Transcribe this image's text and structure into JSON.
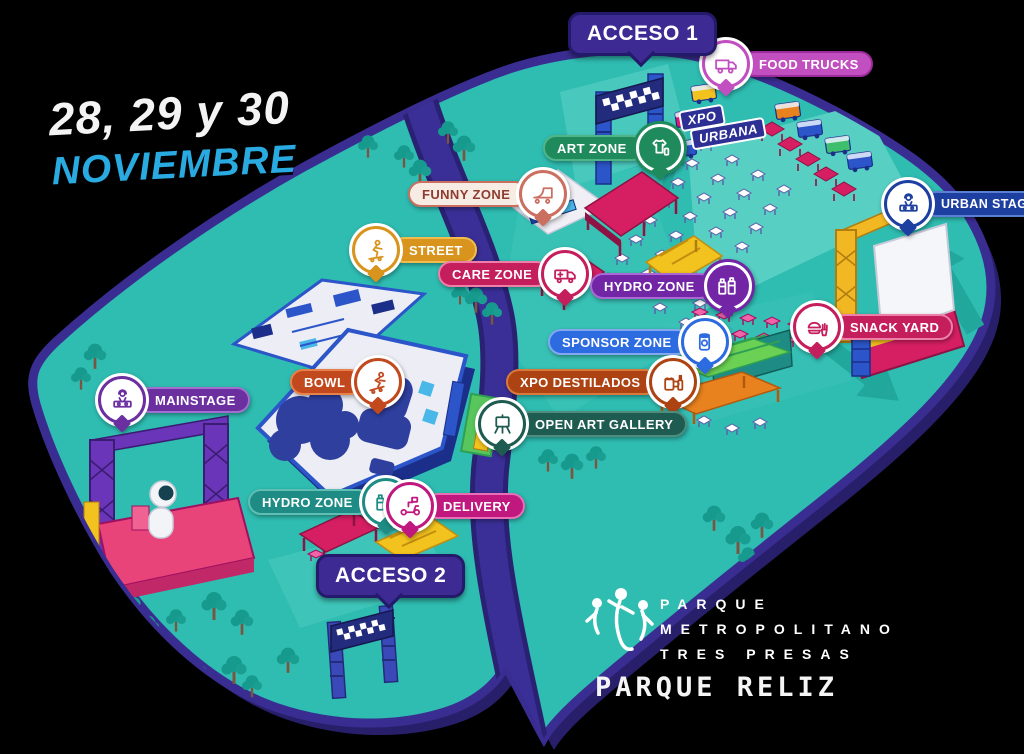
{
  "event": {
    "dates_line1": "28, 29 y 30",
    "dates_line2": "NOVIEMBRE"
  },
  "access": [
    {
      "label": "ACCESO 1"
    },
    {
      "label": "ACCESO 2"
    }
  ],
  "pins": [
    {
      "id": "food-trucks",
      "label": "FOOD TRUCKS",
      "icon": "food-truck-icon",
      "icon_side": "left",
      "color": "#C24FC0",
      "border": "#9E2B9B"
    },
    {
      "id": "art-zone",
      "label": "ART ZONE",
      "icon": "tshirt-icon",
      "icon_side": "right",
      "color": "#1F8A5B",
      "border": "#4FB586"
    },
    {
      "id": "funny-zone",
      "label": "FUNNY ZONE",
      "icon": "mini-ramp-icon",
      "icon_side": "right",
      "color": "#F7ECE4",
      "border": "#CB6F60"
    },
    {
      "id": "street",
      "label": "STREET",
      "icon": "skater-icon",
      "icon_side": "left",
      "color": "#D8941D",
      "border": "#F0BC50"
    },
    {
      "id": "care-zone",
      "label": "CARE ZONE",
      "icon": "ambulance-icon",
      "icon_side": "right",
      "color": "#C41E5C",
      "border": "#ED7FA8"
    },
    {
      "id": "hydro-zone-top",
      "label": "HYDRO ZONE",
      "icon": "water-jugs-icon",
      "icon_side": "right",
      "color": "#7226A6",
      "border": "#A968D4"
    },
    {
      "id": "urban-stage",
      "label": "URBAN STAGE",
      "icon": "dj-icon",
      "icon_side": "left",
      "color": "#1C3FA0",
      "border": "#5B7FD6"
    },
    {
      "id": "sponsor-zone",
      "label": "SPONSOR ZONE",
      "icon": "drink-can-icon",
      "icon_side": "right",
      "color": "#2D6BE0",
      "border": "#82A8F0"
    },
    {
      "id": "snack-yard",
      "label": "SNACK YARD",
      "icon": "burger-fries-icon",
      "icon_side": "left",
      "color": "#C41E5C",
      "border": "#ED7FA8"
    },
    {
      "id": "xpo-destilados",
      "label": "XPO DESTILADOS",
      "icon": "beer-mug-icon",
      "icon_side": "right",
      "color": "#AD4312",
      "border": "#D97A3D"
    },
    {
      "id": "open-art-gallery",
      "label": "OPEN ART GALLERY",
      "icon": "easel-icon",
      "icon_side": "left",
      "color": "#1E5B50",
      "border": "#4E8C7E"
    },
    {
      "id": "bowl",
      "label": "BOWL",
      "icon": "bowl-skater-icon",
      "icon_side": "right",
      "color": "#C2491D",
      "border": "#E8824A"
    },
    {
      "id": "mainstage",
      "label": "MAINSTAGE",
      "icon": "dj-icon",
      "icon_side": "left",
      "color": "#6B2FA0",
      "border": "#A06FD0"
    },
    {
      "id": "hydro-zone-bottom",
      "label": "HYDRO ZONE",
      "icon": "water-jugs-icon",
      "icon_side": "right",
      "color": "#1E8C85",
      "border": "#5FBFB5"
    },
    {
      "id": "delivery",
      "label": "DELIVERY",
      "icon": "delivery-scooter-icon",
      "icon_side": "left",
      "color": "#C0187E",
      "border": "#E86FB5"
    }
  ],
  "xpo_urbana_sign": {
    "line1": "XPO",
    "line2": "URBANA"
  },
  "footer": {
    "park_lines": [
      "PARQUE",
      "METROPOLITANO",
      "TRES PRESAS"
    ],
    "venue": "PARQUE RELIZ"
  },
  "palette": {
    "background": "#000000",
    "ground": "#2FBCB1",
    "ground_light": "#57CFC3",
    "outline": "#3A2D91",
    "shadow": "#281F6B",
    "road": "#3A2F96",
    "tree": "#1A9C90",
    "date_accent": "#29ABE2",
    "access_bubble": "#3D2B93",
    "stage_pink": "#E8447A",
    "truss_yellow": "#F2B824",
    "tent_crimson": "#D61F63"
  }
}
